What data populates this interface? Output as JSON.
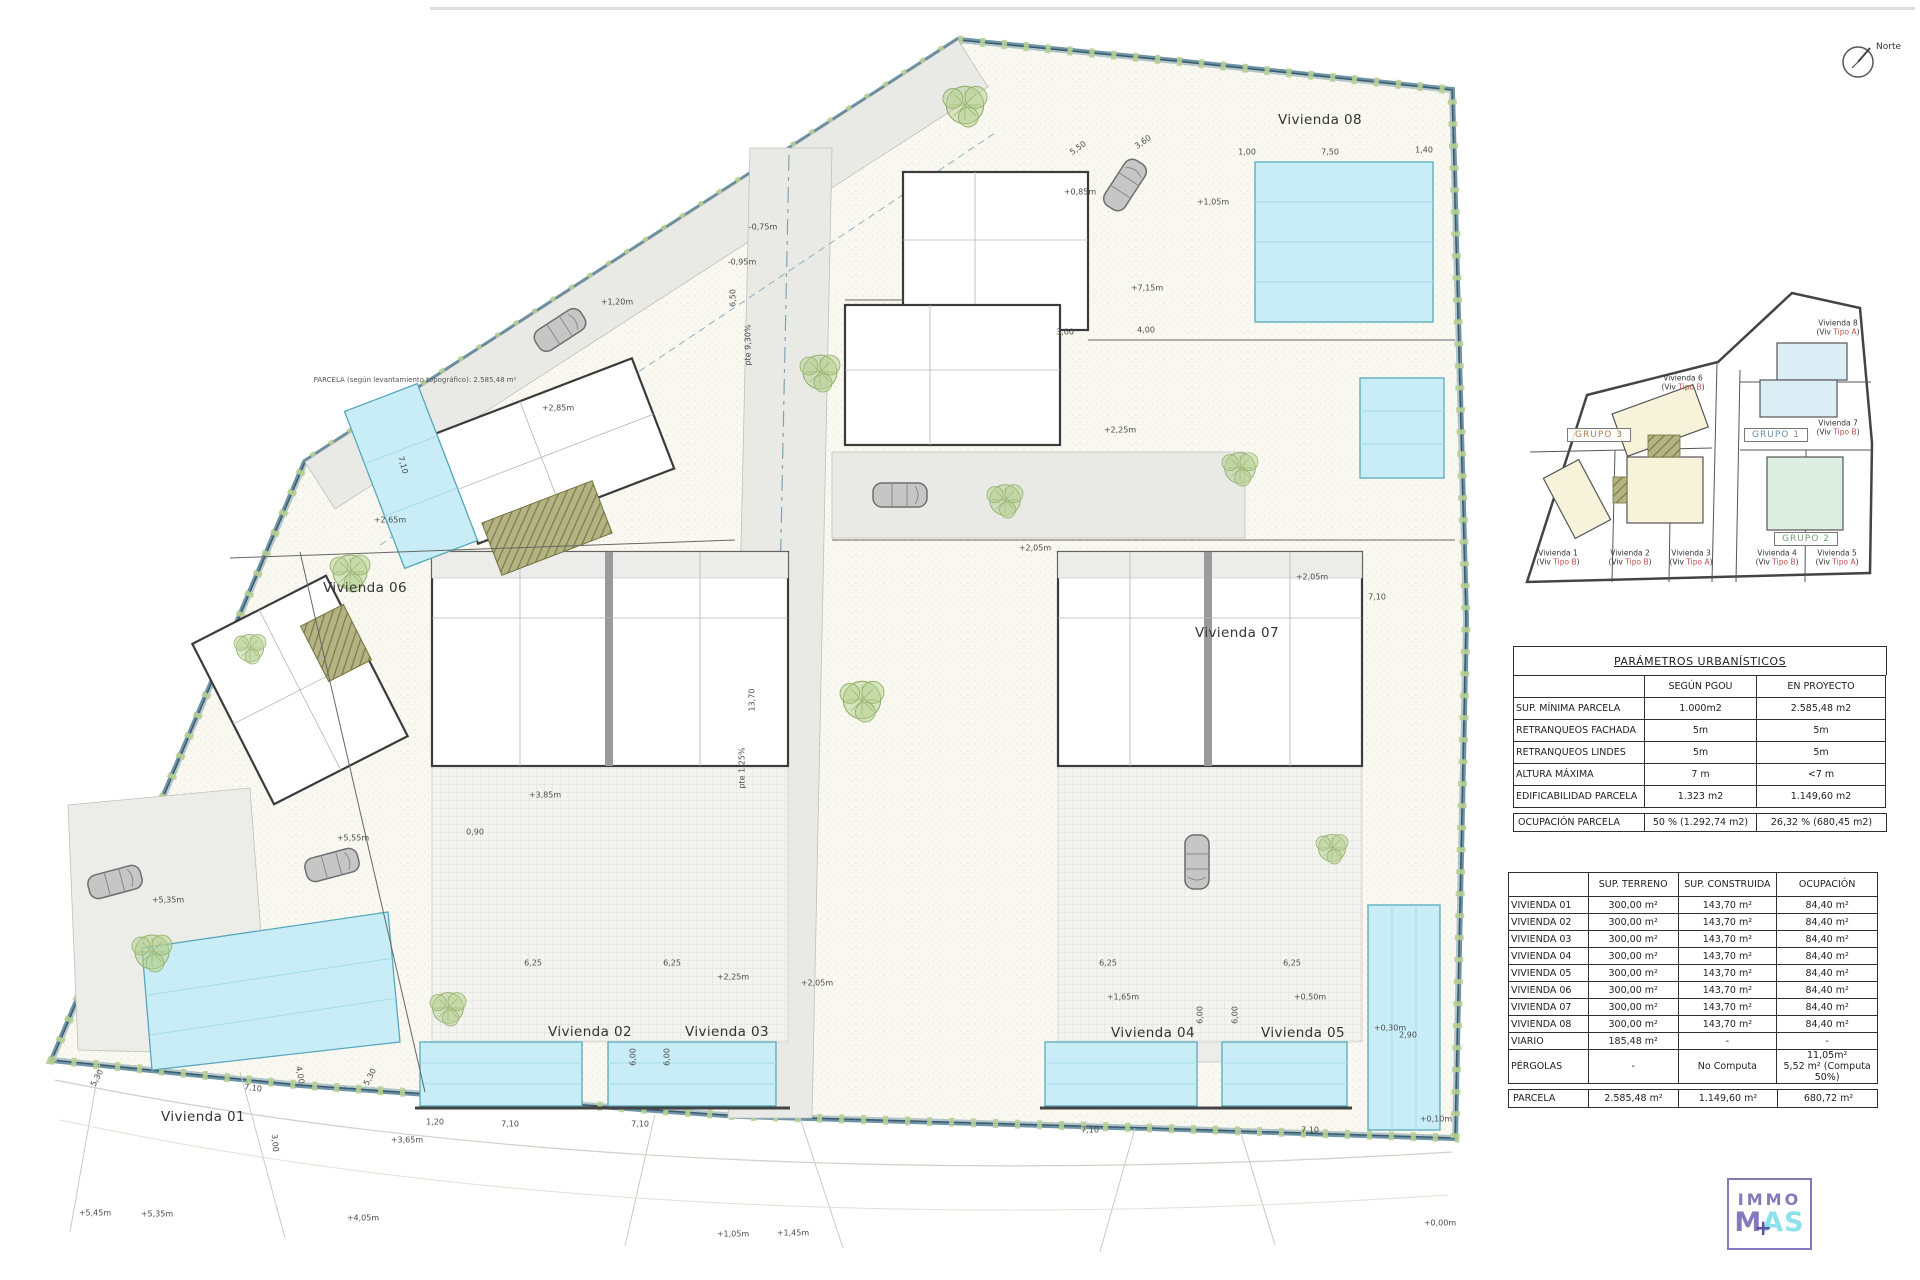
{
  "north": {
    "label": "Norte"
  },
  "plan": {
    "annotations": [
      {
        "t": "Vivienda 01",
        "x": 203,
        "y": 1117,
        "c": "plot"
      },
      {
        "t": "Vivienda 02",
        "x": 590,
        "y": 1032,
        "c": "plot"
      },
      {
        "t": "Vivienda 03",
        "x": 727,
        "y": 1032,
        "c": "plot"
      },
      {
        "t": "Vivienda 04",
        "x": 1153,
        "y": 1033,
        "c": "plot"
      },
      {
        "t": "Vivienda 05",
        "x": 1303,
        "y": 1033,
        "c": "plot"
      },
      {
        "t": "Vivienda 06",
        "x": 365,
        "y": 588,
        "c": "plot"
      },
      {
        "t": "Vivienda 07",
        "x": 1237,
        "y": 633,
        "c": "plot"
      },
      {
        "t": "Vivienda 08",
        "x": 1320,
        "y": 120,
        "c": "plot"
      },
      {
        "t": "PARCELA (según levantamiento topográfico): 2.585,48 m²",
        "x": 415,
        "y": 380,
        "c": "note"
      },
      {
        "t": "+5,45m",
        "x": 95,
        "y": 1213
      },
      {
        "t": "+5,35m",
        "x": 157,
        "y": 1214
      },
      {
        "t": "+4,05m",
        "x": 363,
        "y": 1218
      },
      {
        "t": "+3,65m",
        "x": 407,
        "y": 1140
      },
      {
        "t": "+5,55m",
        "x": 353,
        "y": 838
      },
      {
        "t": "+5,35m",
        "x": 168,
        "y": 900
      },
      {
        "t": "+3,85m",
        "x": 545,
        "y": 795
      },
      {
        "t": "0,90",
        "x": 475,
        "y": 832
      },
      {
        "t": "+2,25m",
        "x": 733,
        "y": 977
      },
      {
        "t": "+2,05m",
        "x": 817,
        "y": 983
      },
      {
        "t": "+1,65m",
        "x": 1123,
        "y": 997
      },
      {
        "t": "+0,50m",
        "x": 1310,
        "y": 997
      },
      {
        "t": "+0,30m",
        "x": 1390,
        "y": 1028
      },
      {
        "t": "+0,85m",
        "x": 1080,
        "y": 192
      },
      {
        "t": "+1,05m",
        "x": 1213,
        "y": 202
      },
      {
        "t": "+7,15m",
        "x": 1147,
        "y": 288
      },
      {
        "t": "+2,25m",
        "x": 1120,
        "y": 430
      },
      {
        "t": "+2,05m",
        "x": 1035,
        "y": 548
      },
      {
        "t": "+2,65m",
        "x": 390,
        "y": 520
      },
      {
        "t": "+2,85m",
        "x": 558,
        "y": 408
      },
      {
        "t": "+2,05m",
        "x": 1312,
        "y": 577
      },
      {
        "t": "+1,20m",
        "x": 617,
        "y": 302
      },
      {
        "t": "-0,75m",
        "x": 763,
        "y": 227
      },
      {
        "t": "-0,95m",
        "x": 742,
        "y": 262
      },
      {
        "t": "+1,05m",
        "x": 733,
        "y": 1234
      },
      {
        "t": "+1,45m",
        "x": 793,
        "y": 1233
      },
      {
        "t": "+0,10m",
        "x": 1436,
        "y": 1119
      },
      {
        "t": "+0,00m",
        "x": 1440,
        "y": 1223
      },
      {
        "t": "7,10",
        "x": 1377,
        "y": 597
      },
      {
        "t": "1,00",
        "x": 1247,
        "y": 152
      },
      {
        "t": "7,50",
        "x": 1330,
        "y": 152
      },
      {
        "t": "1,40",
        "x": 1424,
        "y": 150
      },
      {
        "t": "3,00",
        "x": 1065,
        "y": 332
      },
      {
        "t": "4,00",
        "x": 1146,
        "y": 330
      },
      {
        "t": "6,00",
        "x": 633,
        "y": 1057,
        "r": -90
      },
      {
        "t": "6,00",
        "x": 667,
        "y": 1057,
        "r": -90
      },
      {
        "t": "6,00",
        "x": 1200,
        "y": 1015,
        "r": -90
      },
      {
        "t": "6,00",
        "x": 1235,
        "y": 1015,
        "r": -90
      },
      {
        "t": "6,25",
        "x": 533,
        "y": 963
      },
      {
        "t": "6,25",
        "x": 672,
        "y": 963
      },
      {
        "t": "6,25",
        "x": 1108,
        "y": 963
      },
      {
        "t": "6,25",
        "x": 1292,
        "y": 963
      },
      {
        "t": "7,10",
        "x": 253,
        "y": 1088,
        "r": 7
      },
      {
        "t": "7,10",
        "x": 510,
        "y": 1124
      },
      {
        "t": "7,10",
        "x": 640,
        "y": 1124
      },
      {
        "t": "7,10",
        "x": 1090,
        "y": 1130
      },
      {
        "t": "7,10",
        "x": 1310,
        "y": 1130
      },
      {
        "t": "7,10",
        "x": 403,
        "y": 465,
        "r": 75
      },
      {
        "t": "1,20",
        "x": 435,
        "y": 1122
      },
      {
        "t": "2,90",
        "x": 1408,
        "y": 1035
      },
      {
        "t": "5,30",
        "x": 97,
        "y": 1078,
        "r": -62
      },
      {
        "t": "5,30",
        "x": 370,
        "y": 1077,
        "r": -62
      },
      {
        "t": "3,00",
        "x": 275,
        "y": 1143,
        "r": 85
      },
      {
        "t": "4,00",
        "x": 300,
        "y": 1075,
        "r": 80
      },
      {
        "t": "5,50",
        "x": 1078,
        "y": 148,
        "r": -35
      },
      {
        "t": "3,60",
        "x": 1143,
        "y": 142,
        "r": -35
      },
      {
        "t": "pte 9,30%",
        "x": 748,
        "y": 345,
        "r": -90
      },
      {
        "t": "pte 1,25%",
        "x": 742,
        "y": 768,
        "r": -90
      },
      {
        "t": "6,50",
        "x": 733,
        "y": 298,
        "r": -90
      },
      {
        "t": "13,70",
        "x": 752,
        "y": 700,
        "r": -90
      }
    ]
  },
  "keyplan": {
    "type_prefix": "(Viv ",
    "type_suffix": ")",
    "units": [
      {
        "name": "Vivienda 6",
        "type": "Tipo B",
        "x": 1683,
        "y": 383
      },
      {
        "name": "Vivienda 8",
        "type": "Tipo A",
        "x": 1838,
        "y": 328
      },
      {
        "name": "Vivienda 7",
        "type": "Tipo B",
        "x": 1838,
        "y": 428
      },
      {
        "name": "Vivienda 1",
        "type": "Tipo B",
        "x": 1558,
        "y": 558
      },
      {
        "name": "Vivienda 2",
        "type": "Tipo B",
        "x": 1630,
        "y": 558
      },
      {
        "name": "Vivienda 3",
        "type": "Tipo A",
        "x": 1691,
        "y": 558
      },
      {
        "name": "Vivienda 4",
        "type": "Tipo B",
        "x": 1777,
        "y": 558
      },
      {
        "name": "Vivienda 5",
        "type": "Tipo A",
        "x": 1837,
        "y": 558
      }
    ],
    "groups": [
      {
        "label": "GRUPO 3",
        "x": 1599,
        "y": 435,
        "color": "#b08048"
      },
      {
        "label": "GRUPO 1",
        "x": 1776,
        "y": 435,
        "color": "#6b8fa8"
      },
      {
        "label": "GRUPO 2",
        "x": 1806,
        "y": 539,
        "color": "#74a274"
      }
    ]
  },
  "tables": {
    "parametros": {
      "title": "PARÁMETROS URBANÍSTICOS",
      "headers": [
        "",
        "SEGÚN  PGOU",
        "EN PROYECTO"
      ],
      "rows": [
        [
          "SUP. MÍNIMA PARCELA",
          "1.000m2",
          "2.585,48 m2"
        ],
        [
          "RETRANQUEOS FACHADA",
          "5m",
          "5m"
        ],
        [
          "RETRANQUEOS LINDES",
          "5m",
          "5m"
        ],
        [
          "ALTURA MÁXIMA",
          "7 m",
          "<7 m"
        ],
        [
          "EDIFICABILIDAD PARCELA",
          "1.323 m2",
          "1.149,60 m2"
        ]
      ],
      "footer": [
        "OCUPACIÓN PARCELA",
        "50 % (1.292,74 m2)",
        "26,32 % (680,45 m2)"
      ]
    },
    "superficies": {
      "headers": [
        "",
        "SUP.  TERRENO",
        "SUP.  CONSTRUIDA",
        "OCUPACIÓN"
      ],
      "rows": [
        [
          "VIVIENDA 01",
          "300,00 m²",
          "143,70 m²",
          "84,40 m²"
        ],
        [
          "VIVIENDA 02",
          "300,00 m²",
          "143,70 m²",
          "84,40 m²"
        ],
        [
          "VIVIENDA 03",
          "300,00 m²",
          "143,70 m²",
          "84,40 m²"
        ],
        [
          "VIVIENDA 04",
          "300,00 m²",
          "143,70 m²",
          "84,40 m²"
        ],
        [
          "VIVIENDA 05",
          "300,00 m²",
          "143,70 m²",
          "84,40 m²"
        ],
        [
          "VIVIENDA 06",
          "300,00 m²",
          "143,70 m²",
          "84,40 m²"
        ],
        [
          "VIVIENDA 07",
          "300,00 m²",
          "143,70 m²",
          "84,40 m²"
        ],
        [
          "VIVIENDA 08",
          "300,00 m²",
          "143,70 m²",
          "84,40 m²"
        ],
        [
          "VIARIO",
          "185,48 m²",
          "-",
          "-"
        ],
        [
          "PÉRGOLAS",
          "-",
          "No Computa",
          "11,05m²\n5,52 m² (Computa 50%)"
        ]
      ],
      "footer": [
        "PARCELA",
        "2.585,48 m²",
        "1.149,60 m²",
        "680,72 m²"
      ]
    }
  },
  "logo": {
    "line1": "IMMO",
    "m": "M",
    "a": "A",
    "s": "S",
    "plus": "+"
  }
}
